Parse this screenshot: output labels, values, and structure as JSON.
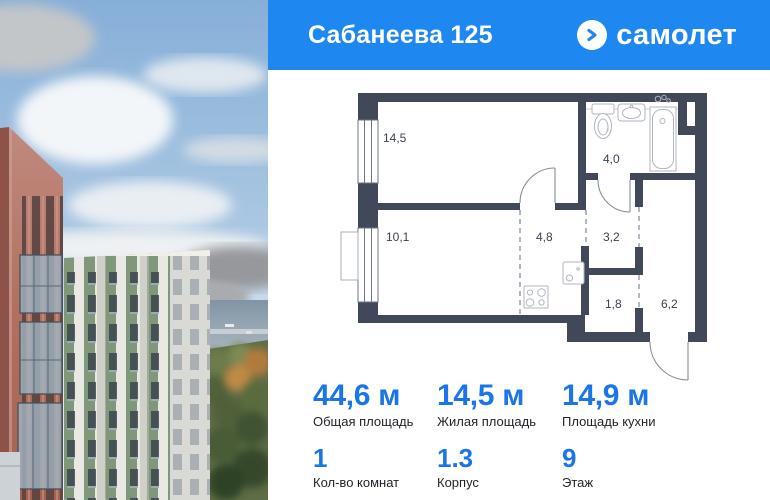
{
  "header": {
    "title": "Сабанеева 125",
    "brand": "самолет",
    "logo_icon": "arrow-circle-icon",
    "bg_color": "#1f87f0"
  },
  "floor_plan": {
    "wall_color": "#404859",
    "rooms": [
      {
        "name": "living-room",
        "area": "14,5"
      },
      {
        "name": "bedroom",
        "area": "10,1"
      },
      {
        "name": "kitchen",
        "area": "4,8"
      },
      {
        "name": "hallway",
        "area": "3,2"
      },
      {
        "name": "bathroom",
        "area": "4,0"
      },
      {
        "name": "storage",
        "area": "1,8"
      },
      {
        "name": "entrance-hall",
        "area": "6,2"
      }
    ]
  },
  "stats": {
    "accent_color": "#1a75e8",
    "primary": [
      {
        "value": "44,6 м",
        "label": "Общая площадь"
      },
      {
        "value": "14,5 м",
        "label": "Жилая площадь"
      },
      {
        "value": "14,9 м",
        "label": "Площадь кухни"
      }
    ],
    "secondary": [
      {
        "value": "1",
        "label": "Кол-во комнат"
      },
      {
        "value": "1.3",
        "label": "Корпус"
      },
      {
        "value": "9",
        "label": "Этаж"
      }
    ]
  }
}
